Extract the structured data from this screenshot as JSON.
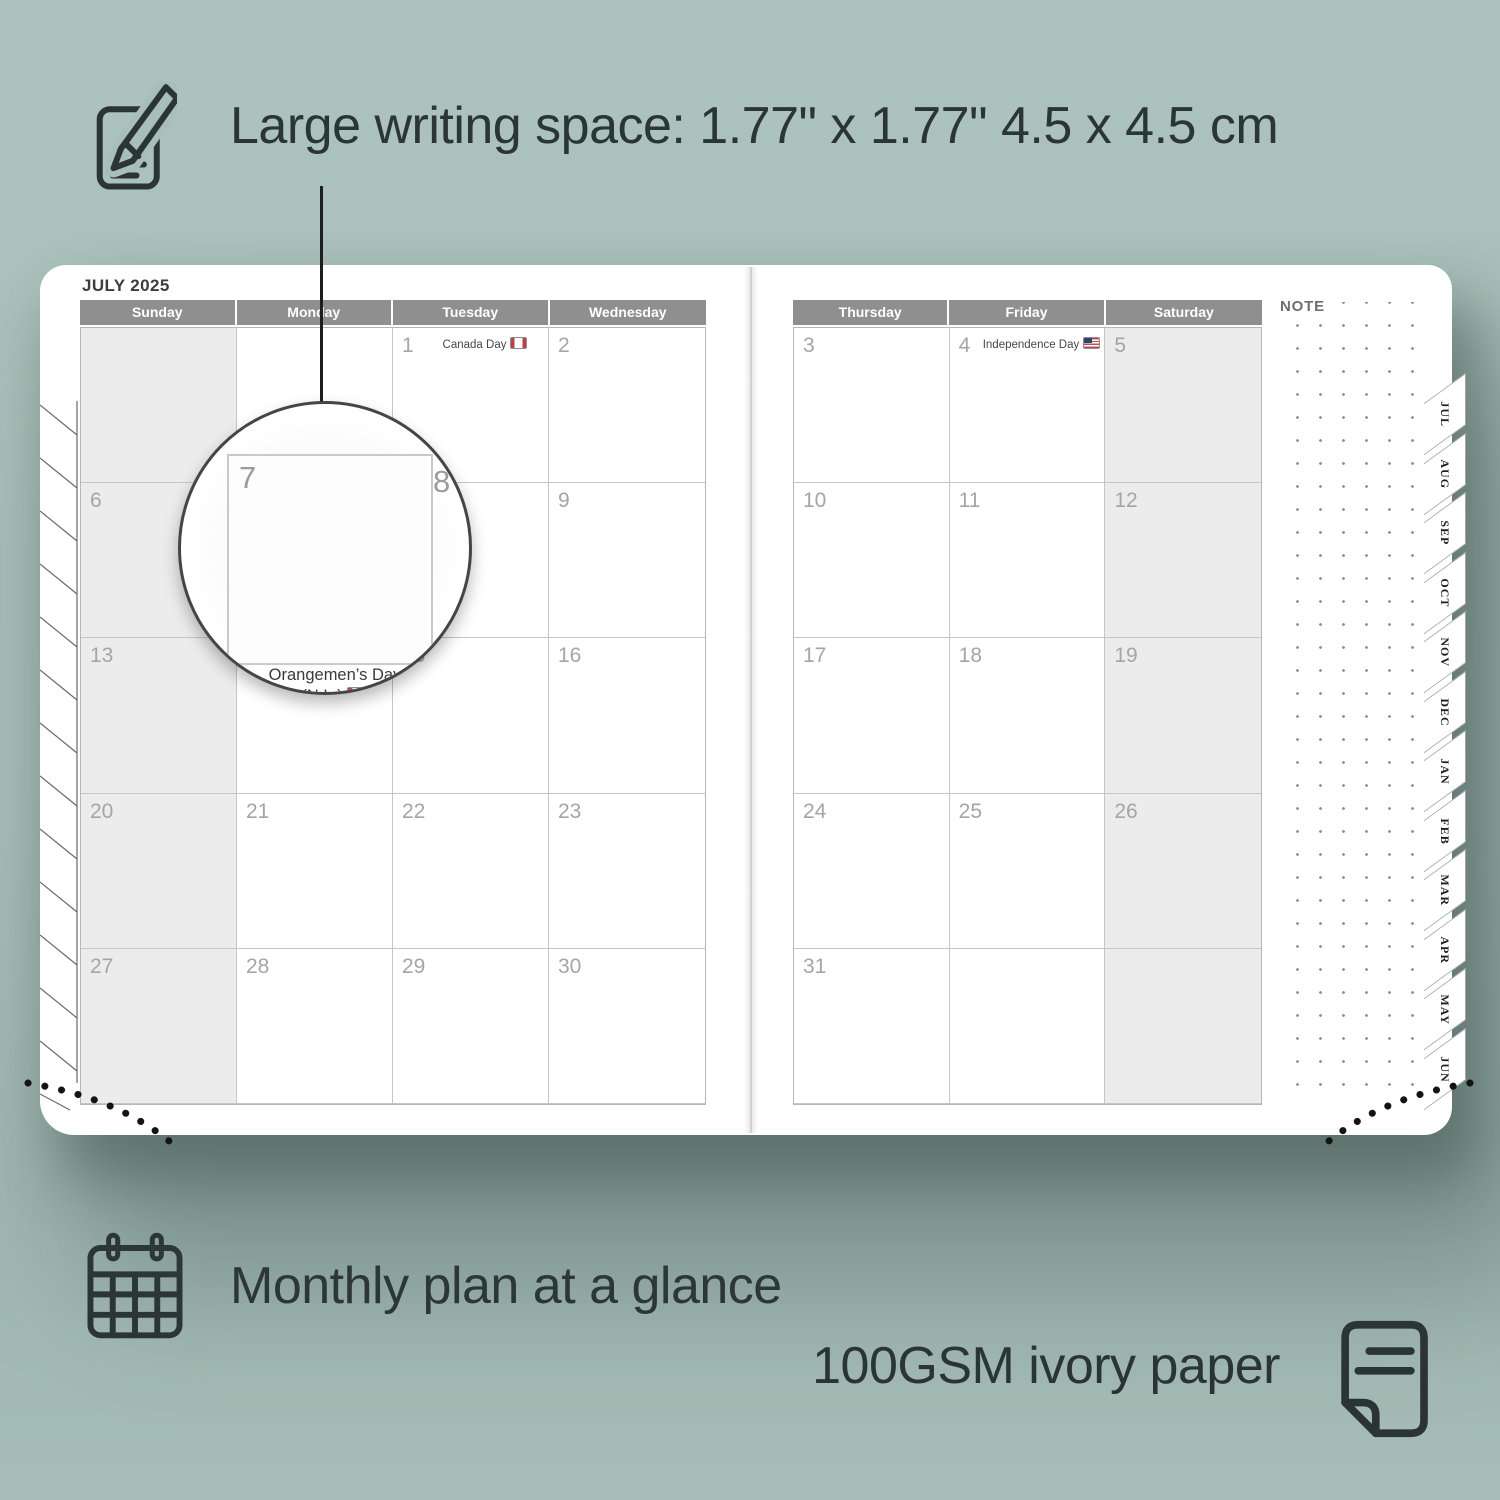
{
  "colors": {
    "background": "#a8bfb9",
    "ink": "#2b3533",
    "header_gray": "#8f8f8f",
    "shade_gray": "#ececec",
    "page_white": "#ffffff"
  },
  "annotations": {
    "writing_space": "Large writing space: 1.77\" x 1.77\" 4.5 x 4.5 cm",
    "monthly_plan": "Monthly plan at a glance",
    "paper": "100GSM ivory paper"
  },
  "planner": {
    "title": "JULY 2025",
    "note_label": "NOTE",
    "left_page": {
      "day_headers": [
        "Sunday",
        "Monday",
        "Tuesday",
        "Wednesday"
      ],
      "rows": [
        [
          {
            "d": ""
          },
          {
            "d": ""
          },
          {
            "d": "1",
            "h": "Canada Day",
            "f": "ca"
          },
          {
            "d": "2"
          }
        ],
        [
          {
            "d": "6"
          },
          {
            "d": "7"
          },
          {
            "d": "8"
          },
          {
            "d": "9"
          }
        ],
        [
          {
            "d": "13"
          },
          {
            "d": "14",
            "h": "Orangemen’s Day (N.L.)",
            "f": "ca"
          },
          {
            "d": "15"
          },
          {
            "d": "16"
          }
        ],
        [
          {
            "d": "20"
          },
          {
            "d": "21"
          },
          {
            "d": "22"
          },
          {
            "d": "23"
          }
        ],
        [
          {
            "d": "27"
          },
          {
            "d": "28"
          },
          {
            "d": "29"
          },
          {
            "d": "30"
          }
        ]
      ]
    },
    "right_page": {
      "day_headers": [
        "Thursday",
        "Friday",
        "Saturday"
      ],
      "rows": [
        [
          {
            "d": "3"
          },
          {
            "d": "4",
            "h": "Independence Day",
            "f": "us"
          },
          {
            "d": "5"
          }
        ],
        [
          {
            "d": "10"
          },
          {
            "d": "11"
          },
          {
            "d": "12"
          }
        ],
        [
          {
            "d": "17"
          },
          {
            "d": "18"
          },
          {
            "d": "19"
          }
        ],
        [
          {
            "d": "24"
          },
          {
            "d": "25"
          },
          {
            "d": "26"
          }
        ],
        [
          {
            "d": "31"
          },
          {
            "d": ""
          },
          {
            "d": ""
          }
        ]
      ]
    },
    "tabs": [
      "JUL",
      "AUG",
      "SEP",
      "OCT",
      "NOV",
      "DEC",
      "JAN",
      "FEB",
      "MAR",
      "APR",
      "MAY",
      "JUN"
    ],
    "magnifier": {
      "day": "7",
      "adjacent_day": "8",
      "prev_day": "14",
      "holiday_line1": "Orangemen’s Day",
      "holiday_line2": "(N.L.)",
      "flag": "ca"
    }
  }
}
